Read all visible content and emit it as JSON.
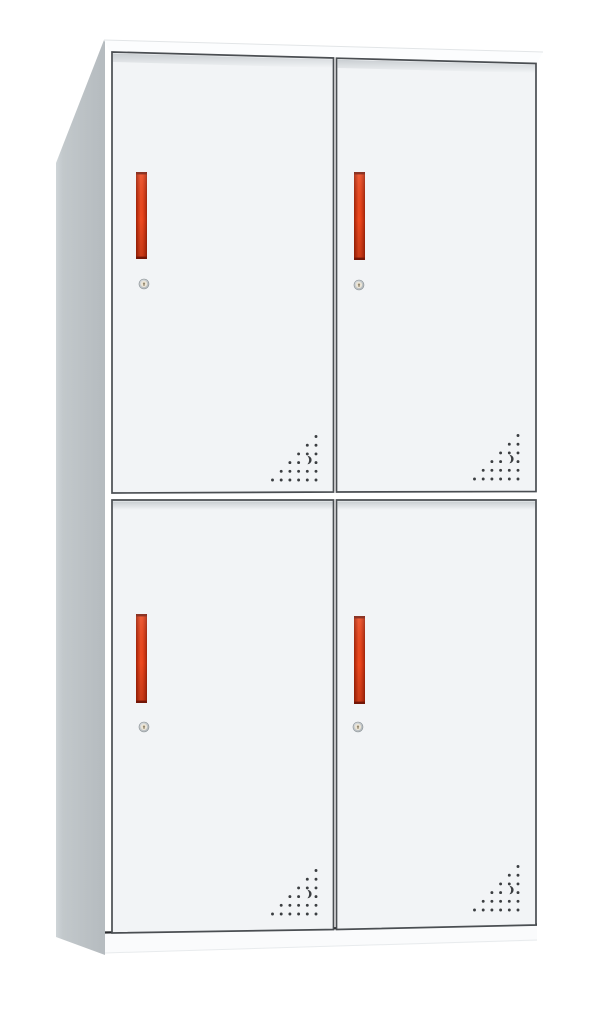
{
  "meta": {
    "content_type": "product-photo",
    "subject": "Two-tier four-door white steel locker cabinet with vertical red handles, round cam locks and perforated vent holes",
    "view": "front three-quarter view, left side panel visible, plain white background"
  },
  "cabinet": {
    "structure": {
      "door_rows": 2,
      "door_columns": 2,
      "doors_total": 4
    },
    "doors": [
      {
        "id": "top-left",
        "handle": true,
        "lock": true,
        "vents": true
      },
      {
        "id": "top-right",
        "handle": true,
        "lock": true,
        "vents": true
      },
      {
        "id": "bottom-left",
        "handle": true,
        "lock": true,
        "vents": true
      },
      {
        "id": "bottom-right",
        "handle": true,
        "lock": true,
        "vents": true
      }
    ],
    "vent_pattern": {
      "shape": "right-triangle, right-aligned rows, in bottom-right corner of each door",
      "rows": 6,
      "spacing": 8.7,
      "dot_radius": 1.45,
      "crescent_cutout": true
    },
    "colors": {
      "background": "#ffffff",
      "door_fill": "#f2f4f6",
      "door_border": "#4a4e52",
      "top_face": "#fcfdfe",
      "top_back_edge": "#e2e5e7",
      "side_panel_light": "#cfd5d8",
      "side_panel": "#c2c8cb",
      "side_panel_dark": "#b5bbbf",
      "base": "#fafbfc",
      "base_bottom_edge": "#e8ebed",
      "base_shadow_line": "#26282b",
      "handle_bright": "#ee4b20",
      "handle_red": "#e8431a",
      "handle_mid": "#c23110",
      "handle_edge": "#9e2207",
      "handle_cap": "#7d1a09",
      "lock_ring_light": "#e4e7e8",
      "lock_ring_dark": "#a9afb3",
      "lock_ring_stroke": "#8b9296",
      "lock_face": "#ece5d6",
      "lock_keyhole": "#93876e",
      "vent_dot": "#3b3e41"
    }
  }
}
